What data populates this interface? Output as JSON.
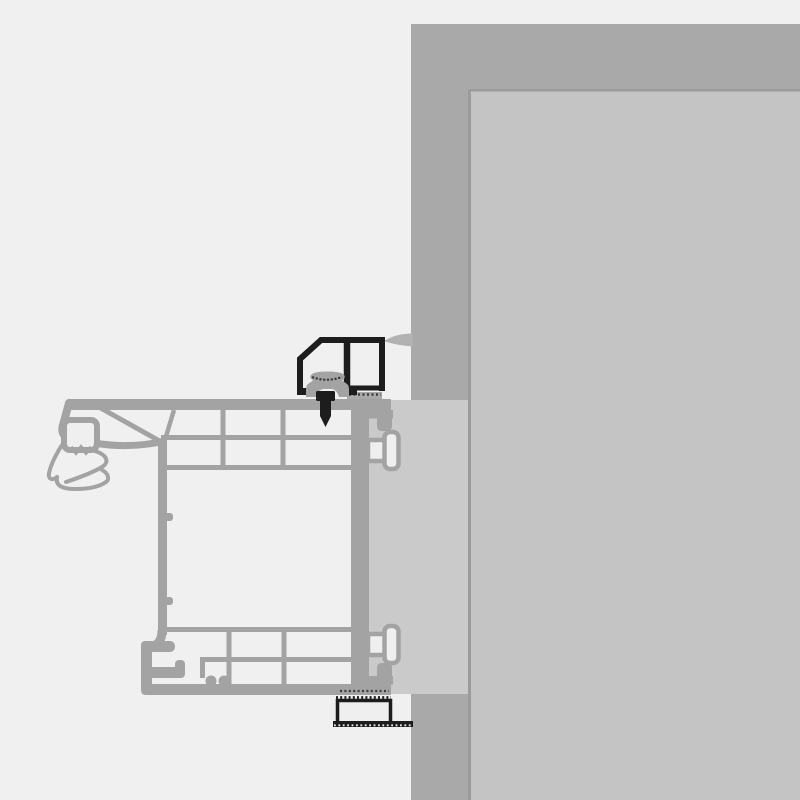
{
  "diagram": {
    "type": "technical-cross-section",
    "subject": "Window frame installation detail at wall reveal (profile section view)",
    "text_labels": [],
    "parts": [
      {
        "name": "wall-outer-band",
        "label": "Wall section, outer band"
      },
      {
        "name": "wall-inner-face",
        "label": "Wall inner face / reveal surface"
      },
      {
        "name": "mounting-gap-filler",
        "label": "Mounting gap filler strip between frame and wall"
      },
      {
        "name": "window-frame-profile",
        "label": "Multi-chamber window frame profile"
      },
      {
        "name": "gasket-seal",
        "label": "Flexible gasket / seal lips at outer edge"
      },
      {
        "name": "anchor-lug-top",
        "label": "Upper T-shaped anchor lug"
      },
      {
        "name": "anchor-lug-bottom",
        "label": "Lower T-shaped anchor lug"
      },
      {
        "name": "mounting-bracket",
        "label": "Black mounting bracket profile on frame head"
      },
      {
        "name": "clip-gasket",
        "label": "Clip gasket inside bracket (hatched cap)"
      },
      {
        "name": "fixing-screw",
        "label": "Fixing screw through frame"
      },
      {
        "name": "sealing-membrane",
        "label": "Sealing membrane sweep to wall"
      },
      {
        "name": "packer-block",
        "label": "Bottom packer block with hatched seal tapes"
      }
    ]
  },
  "palette": {
    "bg": "#f0f0f0",
    "chamber": "#efefef",
    "profile": "#a3a3a3",
    "wallOuter": "#a9a9a9",
    "wallInner": "#c4c4c4",
    "seam": "#9b9b9b",
    "filler": "#cacaca",
    "swoosh": "#b2b2b2",
    "black": "#1d1d1d",
    "hatch": "#3c3c3c"
  }
}
